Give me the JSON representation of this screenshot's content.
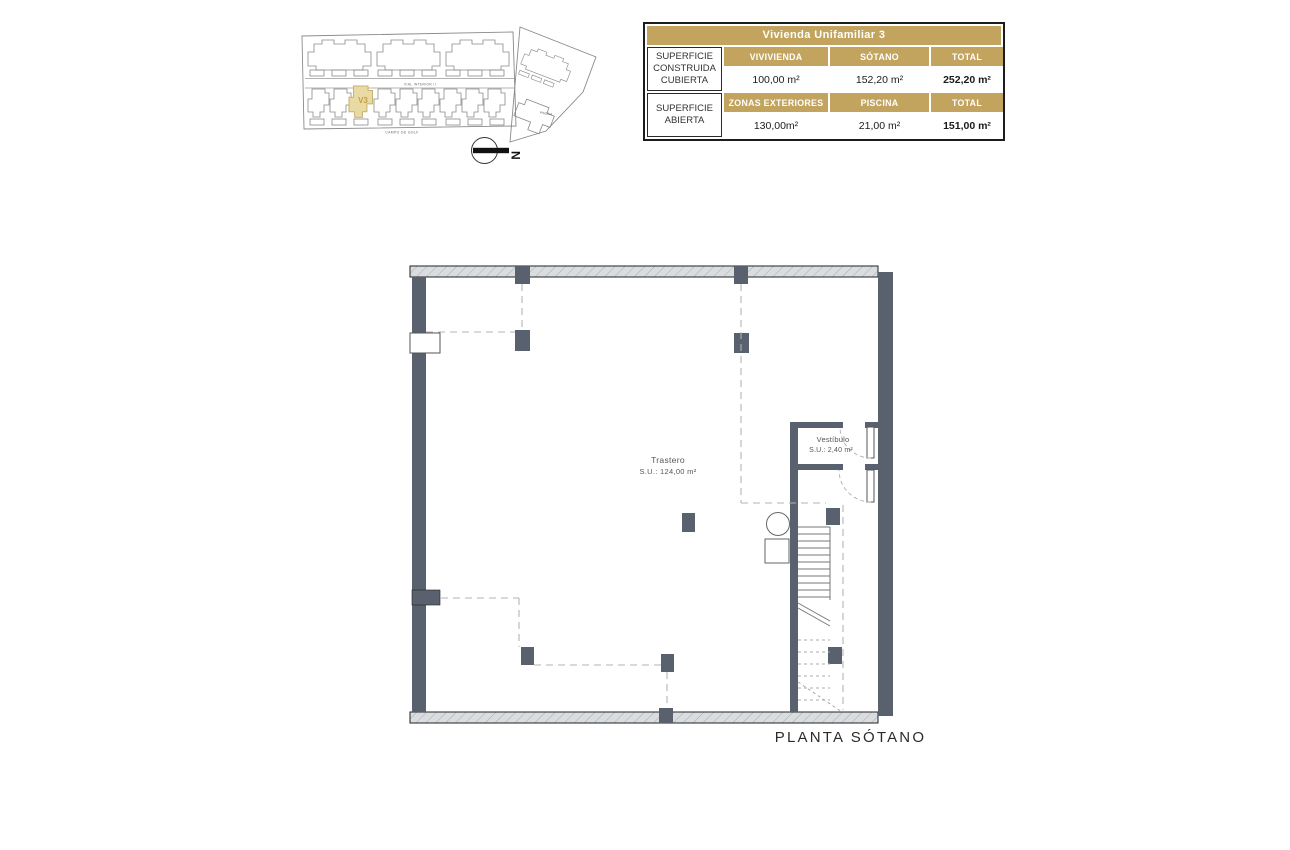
{
  "site_plan": {
    "highlight_label": "V3",
    "street_label": "VIAL INTERIOR II",
    "bottom_label": "CAMPO DE GOLF",
    "right_building_label": "PISCINA",
    "north_label": "N",
    "highlight_color": "#E9DAA4"
  },
  "summary_table": {
    "title": "Vivienda Unifamiliar 3",
    "accent_color": "#C2A45E",
    "rows": [
      {
        "label": "SUPERFICIE CONSTRUIDA CUBIERTA",
        "headers": [
          "VIVIVIENDA",
          "SÓTANO",
          "TOTAL"
        ],
        "values": [
          "100,00 m²",
          "152,20 m²",
          "252,20 m²"
        ]
      },
      {
        "label": "SUPERFICIE ABIERTA",
        "headers": [
          "ZONAS EXTERIORES",
          "PISCINA",
          "TOTAL"
        ],
        "values": [
          "130,00m²",
          "21,00 m²",
          "151,00 m²"
        ]
      }
    ]
  },
  "floor_plan": {
    "rooms": [
      {
        "name": "Trastero",
        "area": "S.U.: 124,00 m²"
      },
      {
        "name": "Vestíbulo",
        "area": "S.U.: 2,40 m²"
      }
    ],
    "caption": "PLANTA SÓTANO",
    "wall_color": "#59616E"
  }
}
